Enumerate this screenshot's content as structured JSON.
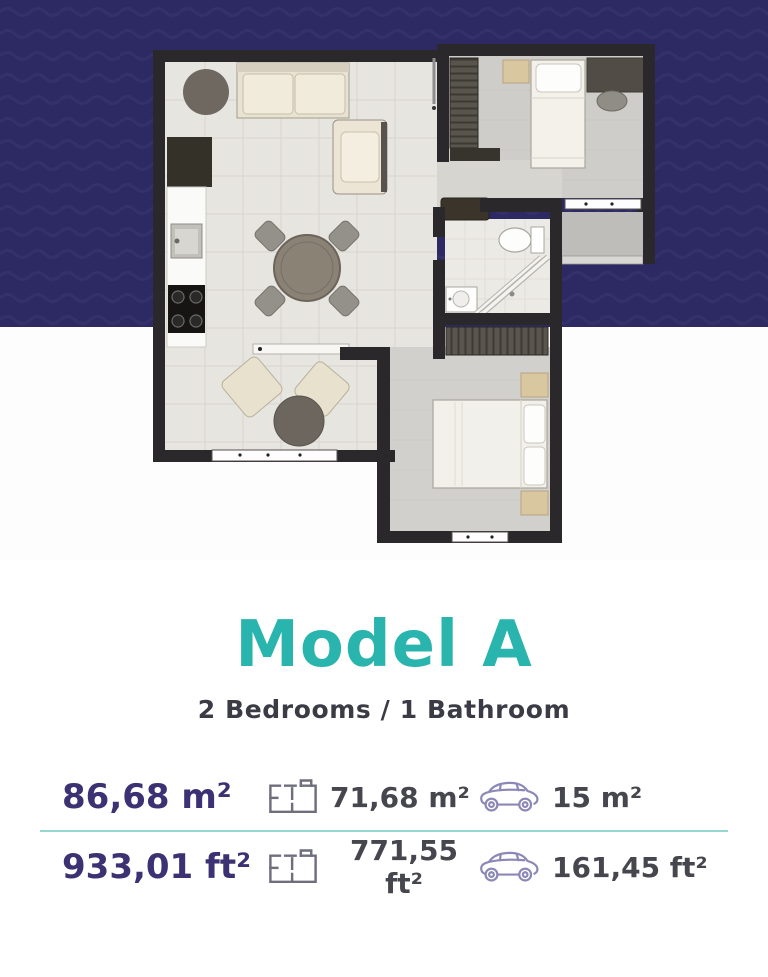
{
  "theme": {
    "navy_background": "#2c2963",
    "navy_wave": "#3b3770",
    "accent_teal": "#2ab4ae",
    "divider_teal": "#96d7d2",
    "primary_purple": "#3b3173",
    "secondary_gray": "#46464e",
    "floorplan_icon_color": "#6e6e7d",
    "car_icon_color": "#8b88b7"
  },
  "title": {
    "text": "Model A"
  },
  "subtitle": {
    "text": "2 Bedrooms / 1 Bathroom"
  },
  "stats": {
    "rows": [
      {
        "total": "86,68 m²",
        "interior": "71,68 m²",
        "parking": "15 m²"
      },
      {
        "total": "933,01 ft²",
        "interior": "771,55 ft²",
        "parking": "161,45 ft²"
      }
    ],
    "icons": {
      "interior": "floorplan-icon",
      "parking": "car-icon"
    }
  },
  "floorplan": {
    "rooms": [
      "living-dining-kitchen",
      "bedroom-1",
      "bathroom",
      "bedroom-2",
      "terrace"
    ]
  }
}
